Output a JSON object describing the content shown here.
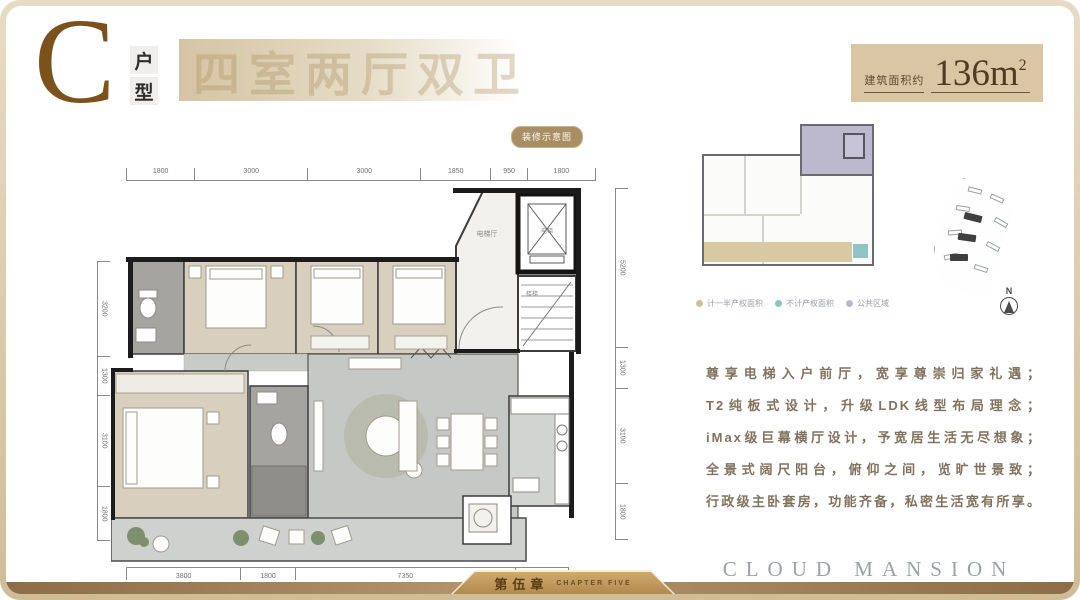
{
  "header": {
    "unit_letter": "C",
    "unit_type_chars": [
      "户",
      "型"
    ],
    "headline": "四室两厅双卫",
    "area_label": "建筑面积约",
    "area_value": "136m",
    "area_sup": "2",
    "accent_color": "#7c521c"
  },
  "plan": {
    "badge": "装修示意图",
    "labels": {
      "elevator_hall": "电梯厅",
      "elevator": "电梯",
      "stairs": "楼梯"
    },
    "dims": {
      "top": [
        "1800",
        "3000",
        "3000",
        "1850",
        "950",
        "1800"
      ],
      "left": [
        "3200",
        "1300",
        "3100",
        "1800"
      ],
      "right": [
        "5200",
        "1300",
        "3100",
        "1800"
      ],
      "bottom": [
        "3800",
        "1800",
        "7350",
        "1750"
      ]
    }
  },
  "sidebar": {
    "legend": [
      {
        "label": "计一半产权面积",
        "color": "#cfc09b"
      },
      {
        "label": "不计产权面积",
        "color": "#8fc3c6"
      },
      {
        "label": "公共区域",
        "color": "#bcb9ce"
      }
    ],
    "compass_label": "N",
    "description_lines": [
      "尊享电梯入户前厅，宽享尊崇归家礼遇；",
      "T2纯板式设计，升级LDK线型布局理念；",
      "iMax级巨幕横厅设计，予宽居生活无尽想象；",
      "全景式阔尺阳台，俯仰之间，览旷世景致；",
      "行政级主卧套房，功能齐备，私密生活宽有所享。"
    ],
    "brand": "CLOUD MANSION"
  },
  "footer": {
    "chapter_cn": "第伍章",
    "chapter_en": "CHAPTER FIVE"
  }
}
